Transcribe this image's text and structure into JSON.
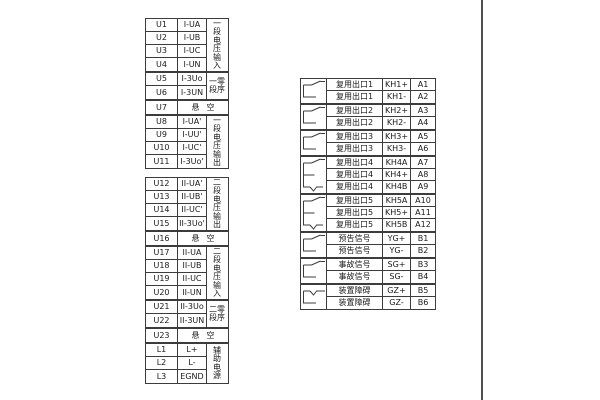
{
  "diagram_title": "terminal-wiring-diagram",
  "colors": {
    "line": "#3c3c3c",
    "text": "#1a1a1a",
    "background": "#ffffff"
  },
  "contact_types": {
    "no": "normally-open-contact",
    "co": "changeover-contact",
    "nc": "normally-closed-contact"
  },
  "left_tables": [
    {
      "groups": [
        {
          "label": "一\n段\n电\n压\n输\n入",
          "rows": [
            [
              "U1",
              "I-UA"
            ],
            [
              "U2",
              "I-UB"
            ],
            [
              "U3",
              "I-UC"
            ],
            [
              "U4",
              "I-UN"
            ]
          ]
        },
        {
          "label": "一零\n段序",
          "rows": [
            [
              "U5",
              "I-3Uo"
            ],
            [
              "U6",
              "I-3UN"
            ]
          ]
        },
        {
          "span": true,
          "rows": [
            [
              "U7",
              "悬空"
            ]
          ]
        },
        {
          "label": "一\n段\n电\n压\n输\n出",
          "rows": [
            [
              "U8",
              "I-UA'"
            ],
            [
              "U9",
              "I-UU'"
            ],
            [
              "U10",
              "I-UC'"
            ],
            [
              "U11",
              "I-3Uo'"
            ]
          ]
        }
      ]
    },
    {
      "groups": [
        {
          "label": "二\n段\n电\n压\n输\n出",
          "rows": [
            [
              "U12",
              "II-UA'"
            ],
            [
              "U13",
              "II-UB'"
            ],
            [
              "U14",
              "II-UC'"
            ],
            [
              "U15",
              "II-3Uo'"
            ]
          ]
        },
        {
          "span": true,
          "rows": [
            [
              "U16",
              "悬空"
            ]
          ]
        },
        {
          "label": "二\n段\n电\n压\n输\n入",
          "rows": [
            [
              "U17",
              "II-UA"
            ],
            [
              "U18",
              "II-UB"
            ],
            [
              "U19",
              "II-UC"
            ],
            [
              "U20",
              "II-UN"
            ]
          ]
        },
        {
          "label": "二零\n段序",
          "rows": [
            [
              "U21",
              "II-3Uo"
            ],
            [
              "U22",
              "II-3UN"
            ]
          ]
        },
        {
          "span": true,
          "rows": [
            [
              "U23",
              "悬空"
            ]
          ]
        },
        {
          "label": "辅\n助\n电\n源",
          "rows": [
            [
              "L1",
              "L+"
            ],
            [
              "L2",
              "L-"
            ],
            [
              "L3",
              "EGND"
            ]
          ]
        }
      ]
    }
  ],
  "right_table": {
    "groups": [
      {
        "symbol": "no",
        "rows": [
          [
            "复用出口1",
            "KH1+",
            "A1"
          ],
          [
            "复用出口1",
            "KH1-",
            "A2"
          ]
        ]
      },
      {
        "symbol": "no",
        "rows": [
          [
            "复用出口2",
            "KH2+",
            "A3"
          ],
          [
            "复用出口2",
            "KH2-",
            "A4"
          ]
        ]
      },
      {
        "symbol": "no",
        "rows": [
          [
            "复用出口3",
            "KH3+",
            "A5"
          ],
          [
            "复用出口3",
            "KH3-",
            "A6"
          ]
        ]
      },
      {
        "symbol": "co",
        "rows": [
          [
            "复用出口4",
            "KH4A",
            "A7"
          ],
          [
            "复用出口4",
            "KH4+",
            "A8"
          ],
          [
            "复用出口4",
            "KH4B",
            "A9"
          ]
        ]
      },
      {
        "symbol": "co",
        "rows": [
          [
            "复用出口5",
            "KH5A",
            "A10"
          ],
          [
            "复用出口5",
            "KH5+",
            "A11"
          ],
          [
            "复用出口5",
            "KH5B",
            "A12"
          ]
        ]
      },
      {
        "symbol": "no",
        "rows": [
          [
            "预告信号",
            "YG+",
            "B1"
          ],
          [
            "预告信号",
            "YG-",
            "B2"
          ]
        ]
      },
      {
        "symbol": "no",
        "rows": [
          [
            "事故信号",
            "SG+",
            "B3"
          ],
          [
            "事故信号",
            "SG-",
            "B4"
          ]
        ]
      },
      {
        "symbol": "nc",
        "rows": [
          [
            "装置障碍",
            "GZ+",
            "B5"
          ],
          [
            "装置障碍",
            "GZ-",
            "B6"
          ]
        ]
      }
    ]
  }
}
